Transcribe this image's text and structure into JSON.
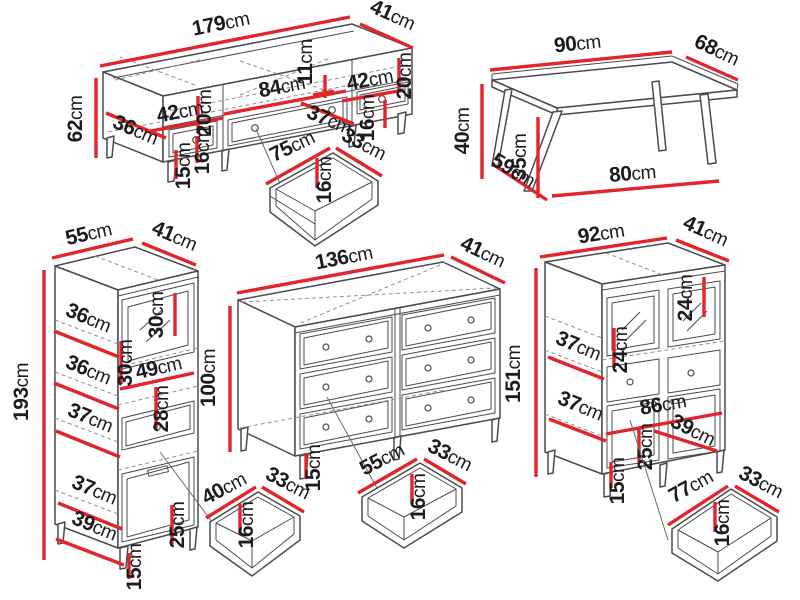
{
  "unit": "cm",
  "colors": {
    "dimension": "#e2242b",
    "outline": "#4b4b4e",
    "label": "#1c1c1e",
    "background": "#ffffff"
  },
  "pieces": {
    "tv_stand": {
      "width": "179",
      "depth": "41",
      "height": "62",
      "base_depth": "36",
      "left_section_width": "42",
      "left_section_height": "20",
      "left_drawer_height": "16",
      "leg_height": "15",
      "middle_section_width": "84",
      "top_shelf_height": "11",
      "inner_depth": "37",
      "right_section_width": "42",
      "right_section_height": "20",
      "right_drawer_height": "16",
      "drawer": {
        "width": "75",
        "depth": "33",
        "height": "16"
      }
    },
    "coffee_table": {
      "width": "90",
      "depth": "68",
      "height": "40",
      "inner_depth": "59",
      "leg_height": "35",
      "inner_width": "80"
    },
    "tall_cabinet": {
      "width": "55",
      "depth": "41",
      "height": "193",
      "shelf_depth_top": "36",
      "top_section_height": "30",
      "glass_section_height": "30",
      "shelf_depth_2": "36",
      "inner_width": "49",
      "drawer_front_height": "28",
      "shelf_depth_3": "37",
      "shelf_depth_4": "37",
      "bottom_section_height": "25",
      "base_depth": "39",
      "leg_height": "15",
      "drawer": {
        "width": "40",
        "depth": "33",
        "height": "16"
      }
    },
    "dresser": {
      "width": "136",
      "depth": "41",
      "height": "100",
      "leg_height": "15",
      "drawer": {
        "width": "55",
        "depth": "33",
        "height": "16"
      }
    },
    "display_cabinet": {
      "width": "92",
      "depth": "41",
      "height": "151",
      "glass_height_right": "24",
      "glass_height_center": "24",
      "shelf_depth_top": "37",
      "shelf_depth_bottom": "37",
      "inner_width": "86",
      "inner_depth": "39",
      "bottom_section_height": "25",
      "leg_height": "15",
      "drawer": {
        "width": "77",
        "depth": "33",
        "height": "16"
      }
    }
  }
}
